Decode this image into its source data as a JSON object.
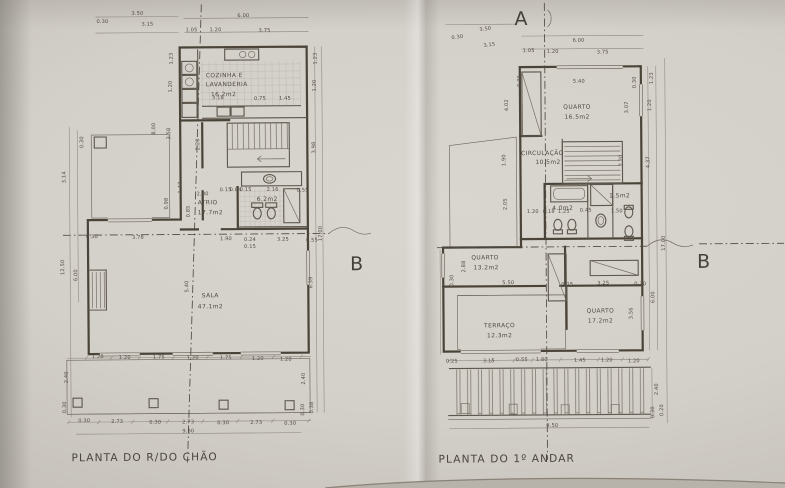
{
  "titles": {
    "left": "PLANTA DO R/DO CHÃO",
    "right": "PLANTA DO 1º ANDAR"
  },
  "sections": {
    "a": "A",
    "b": "B"
  },
  "rooms_left": [
    "COZINHA E LAVANDERIA 16.2m2",
    "ATRIO 17.7m2",
    "WC 6.2m2",
    "SALA 47.1m2"
  ],
  "rooms_right": [
    "QUARTO 16.5m2",
    "CIRCULAÇÃO 10.5m2",
    "WC 4.0m2",
    "DUCHE 1.5m2",
    "QUARTO 13.2m2",
    "TERRAÇO 12.3m2",
    "QUARTO 17.2m2"
  ],
  "colors": {
    "paper": "#d3cfc9",
    "ink": "#494338",
    "dim_ink": "#534d45"
  },
  "labels": [
    {
      "t": "3.50",
      "x": 139,
      "y": 13
    },
    {
      "t": "0.30",
      "x": 104,
      "y": 21
    },
    {
      "t": "3.15",
      "x": 149,
      "y": 24
    },
    {
      "t": "6.00",
      "x": 245,
      "y": 16
    },
    {
      "t": "1.05",
      "x": 193,
      "y": 30
    },
    {
      "t": "1.20",
      "x": 217,
      "y": 30
    },
    {
      "t": "3.75",
      "x": 266,
      "y": 31
    },
    {
      "t": "1.23",
      "x": 174,
      "y": 57,
      "r": -90
    },
    {
      "t": "1.20",
      "x": 173,
      "y": 85,
      "r": -90
    },
    {
      "t": "1.23",
      "x": 318,
      "y": 58,
      "r": -90
    },
    {
      "t": "1.20",
      "x": 317,
      "y": 85,
      "r": -90
    },
    {
      "t": "8.00",
      "x": 156,
      "y": 127,
      "r": -90
    },
    {
      "t": "3.58",
      "x": 171,
      "y": 132,
      "r": -90
    },
    {
      "t": "2.20",
      "x": 200,
      "y": 143,
      "r": -90
    },
    {
      "t": "0.30",
      "x": 84,
      "y": 140,
      "r": -90
    },
    {
      "t": "3.14",
      "x": 66,
      "y": 175,
      "r": -90
    },
    {
      "t": "12.50",
      "x": 64,
      "y": 265,
      "r": -90
    },
    {
      "t": "6.00",
      "x": 77,
      "y": 273,
      "r": -90
    },
    {
      "t": "3.98",
      "x": 316,
      "y": 147,
      "r": -90
    },
    {
      "t": "17.00",
      "x": 322,
      "y": 233,
      "r": -90
    },
    {
      "t": "6.39",
      "x": 312,
      "y": 282,
      "r": -90
    },
    {
      "t": "5.40",
      "x": 188,
      "y": 285,
      "r": -90
    },
    {
      "t": "1.47",
      "x": 182,
      "y": 186,
      "r": -90
    },
    {
      "t": "0.98",
      "x": 168,
      "y": 202,
      "r": -90
    },
    {
      "t": "0.85",
      "x": 190,
      "y": 210,
      "r": -90
    },
    {
      "t": "2.00",
      "x": 203,
      "y": 194
    },
    {
      "t": "3.18",
      "x": 219,
      "y": 98
    },
    {
      "t": "0.75",
      "x": 261,
      "y": 99
    },
    {
      "t": "1.45",
      "x": 286,
      "y": 99
    },
    {
      "t": "0.15",
      "x": 226,
      "y": 190
    },
    {
      "t": "0.84",
      "x": 236,
      "y": 190
    },
    {
      "t": "0.15",
      "x": 246,
      "y": 190
    },
    {
      "t": "2.16",
      "x": 273,
      "y": 190
    },
    {
      "t": "0.55",
      "x": 303,
      "y": 191
    },
    {
      "t": "0.30",
      "x": 92,
      "y": 236
    },
    {
      "t": "3.78",
      "x": 138,
      "y": 237
    },
    {
      "t": "1.90",
      "x": 226,
      "y": 239
    },
    {
      "t": "0.24",
      "x": 250,
      "y": 240
    },
    {
      "t": "0.15",
      "x": 250,
      "y": 247
    },
    {
      "t": "3.25",
      "x": 283,
      "y": 240
    },
    {
      "t": "0.55",
      "x": 312,
      "y": 241
    },
    {
      "t": "1.20",
      "x": 97,
      "y": 356
    },
    {
      "t": "1.20",
      "x": 124,
      "y": 357
    },
    {
      "t": "1.75",
      "x": 158,
      "y": 357
    },
    {
      "t": "1.20",
      "x": 192,
      "y": 358
    },
    {
      "t": "1.75",
      "x": 225,
      "y": 358
    },
    {
      "t": "1.20",
      "x": 257,
      "y": 359
    },
    {
      "t": "1.20",
      "x": 285,
      "y": 360
    },
    {
      "t": "0.30",
      "x": 83,
      "y": 420
    },
    {
      "t": "2.73",
      "x": 116,
      "y": 421
    },
    {
      "t": "0.30",
      "x": 154,
      "y": 422
    },
    {
      "t": "2.73",
      "x": 187,
      "y": 422
    },
    {
      "t": "0.30",
      "x": 222,
      "y": 423
    },
    {
      "t": "2.73",
      "x": 255,
      "y": 423
    },
    {
      "t": "0.30",
      "x": 289,
      "y": 424
    },
    {
      "t": "2.40",
      "x": 67,
      "y": 375,
      "r": -90
    },
    {
      "t": "0.30",
      "x": 65,
      "y": 405,
      "r": -90
    },
    {
      "t": "2.40",
      "x": 304,
      "y": 378,
      "r": -90
    },
    {
      "t": "0.30",
      "x": 303,
      "y": 409,
      "r": -90
    },
    {
      "t": "0.38",
      "x": 312,
      "y": 407,
      "r": -90
    },
    {
      "t": "9.80",
      "x": 187,
      "y": 431
    },
    {
      "t": "COZINHA E",
      "x": 207,
      "y": 76,
      "c": "room",
      "a": "start"
    },
    {
      "t": "LAVANDERIA",
      "x": 207,
      "y": 85,
      "c": "room",
      "a": "start"
    },
    {
      "t": "16.2m2",
      "x": 212,
      "y": 95,
      "c": "room",
      "a": "start"
    },
    {
      "t": "ATRIO",
      "x": 198,
      "y": 203,
      "c": "room",
      "a": "start"
    },
    {
      "t": "17.7m2",
      "x": 198,
      "y": 213,
      "c": "room",
      "a": "start"
    },
    {
      "t": "6.2m2",
      "x": 257,
      "y": 200,
      "c": "room",
      "a": "start"
    },
    {
      "t": "SALA",
      "x": 210,
      "y": 296,
      "c": "room"
    },
    {
      "t": "47.1m2",
      "x": 210,
      "y": 307,
      "c": "room"
    },
    {
      "t": "3.50",
      "x": 487,
      "y": 31,
      "r": -7
    },
    {
      "t": "0.30",
      "x": 459,
      "y": 39,
      "r": -7
    },
    {
      "t": "3.15",
      "x": 491,
      "y": 47,
      "r": -7
    },
    {
      "t": "6.00",
      "x": 580,
      "y": 43
    },
    {
      "t": "1.05",
      "x": 530,
      "y": 53
    },
    {
      "t": "1.20",
      "x": 554,
      "y": 54
    },
    {
      "t": "3.75",
      "x": 604,
      "y": 55
    },
    {
      "t": "0.30",
      "x": 522,
      "y": 82,
      "r": -90
    },
    {
      "t": "5.40",
      "x": 580,
      "y": 84
    },
    {
      "t": "0.30",
      "x": 637,
      "y": 84,
      "r": -90
    },
    {
      "t": "1.23",
      "x": 654,
      "y": 80,
      "r": -90
    },
    {
      "t": "1.20",
      "x": 652,
      "y": 107,
      "r": -90
    },
    {
      "t": "3.07",
      "x": 629,
      "y": 109,
      "r": -90
    },
    {
      "t": "4.02",
      "x": 509,
      "y": 106,
      "r": -90
    },
    {
      "t": "1.90",
      "x": 506,
      "y": 161,
      "r": -90
    },
    {
      "t": "2.20",
      "x": 623,
      "y": 162,
      "r": -90
    },
    {
      "t": "4.37",
      "x": 650,
      "y": 164,
      "r": -90
    },
    {
      "t": "2.05",
      "x": 507,
      "y": 205,
      "r": -90
    },
    {
      "t": "1.20",
      "x": 533,
      "y": 214
    },
    {
      "t": "0.18",
      "x": 549,
      "y": 214
    },
    {
      "t": "1.25",
      "x": 564,
      "y": 214
    },
    {
      "t": "0.45",
      "x": 586,
      "y": 213
    },
    {
      "t": "1.50",
      "x": 617,
      "y": 214
    },
    {
      "t": "17.00",
      "x": 665,
      "y": 245,
      "r": -90
    },
    {
      "t": "2.88",
      "x": 465,
      "y": 267,
      "r": -90
    },
    {
      "t": "0.30",
      "x": 453,
      "y": 281,
      "r": -90
    },
    {
      "t": "5.50",
      "x": 508,
      "y": 285
    },
    {
      "t": "0.15",
      "x": 567,
      "y": 287
    },
    {
      "t": "3.25",
      "x": 603,
      "y": 286
    },
    {
      "t": "0.30",
      "x": 640,
      "y": 287
    },
    {
      "t": "6.00",
      "x": 654,
      "y": 299,
      "r": -90
    },
    {
      "t": "3.56",
      "x": 632,
      "y": 315,
      "r": -90
    },
    {
      "t": "0.25",
      "x": 451,
      "y": 363
    },
    {
      "t": "3.15",
      "x": 488,
      "y": 363
    },
    {
      "t": "0.55",
      "x": 521,
      "y": 362
    },
    {
      "t": "1.80",
      "x": 541,
      "y": 362
    },
    {
      "t": "1.45",
      "x": 579,
      "y": 363
    },
    {
      "t": "1.20",
      "x": 606,
      "y": 363
    },
    {
      "t": "1.20",
      "x": 633,
      "y": 364
    },
    {
      "t": "2.40",
      "x": 657,
      "y": 391,
      "r": -90
    },
    {
      "t": "0.30",
      "x": 653,
      "y": 414,
      "r": -90
    },
    {
      "t": "0.20",
      "x": 662,
      "y": 412,
      "r": -90
    },
    {
      "t": "9.50",
      "x": 545,
      "y": 428,
      "a": "start"
    },
    {
      "t": "QUARTO",
      "x": 578,
      "y": 110,
      "c": "room"
    },
    {
      "t": "16.5m2",
      "x": 578,
      "y": 120,
      "c": "room"
    },
    {
      "t": "CIRCULAÇÃO",
      "x": 543,
      "y": 156,
      "c": "room"
    },
    {
      "t": "10.5m2",
      "x": 536,
      "y": 165,
      "c": "room",
      "a": "start"
    },
    {
      "t": "4.0m2",
      "x": 563,
      "y": 211,
      "c": "room"
    },
    {
      "t": "1.5m2",
      "x": 620,
      "y": 199,
      "c": "room"
    },
    {
      "t": "QUARTO",
      "x": 485,
      "y": 260,
      "c": "room"
    },
    {
      "t": "13.2m2",
      "x": 486,
      "y": 270,
      "c": "room"
    },
    {
      "t": "TERRAÇO",
      "x": 499,
      "y": 328,
      "c": "room"
    },
    {
      "t": "12.3m2",
      "x": 499,
      "y": 338,
      "c": "room"
    },
    {
      "t": "QUARTO",
      "x": 600,
      "y": 314,
      "c": "room"
    },
    {
      "t": "17.2m2",
      "x": 600,
      "y": 324,
      "c": "room"
    }
  ]
}
